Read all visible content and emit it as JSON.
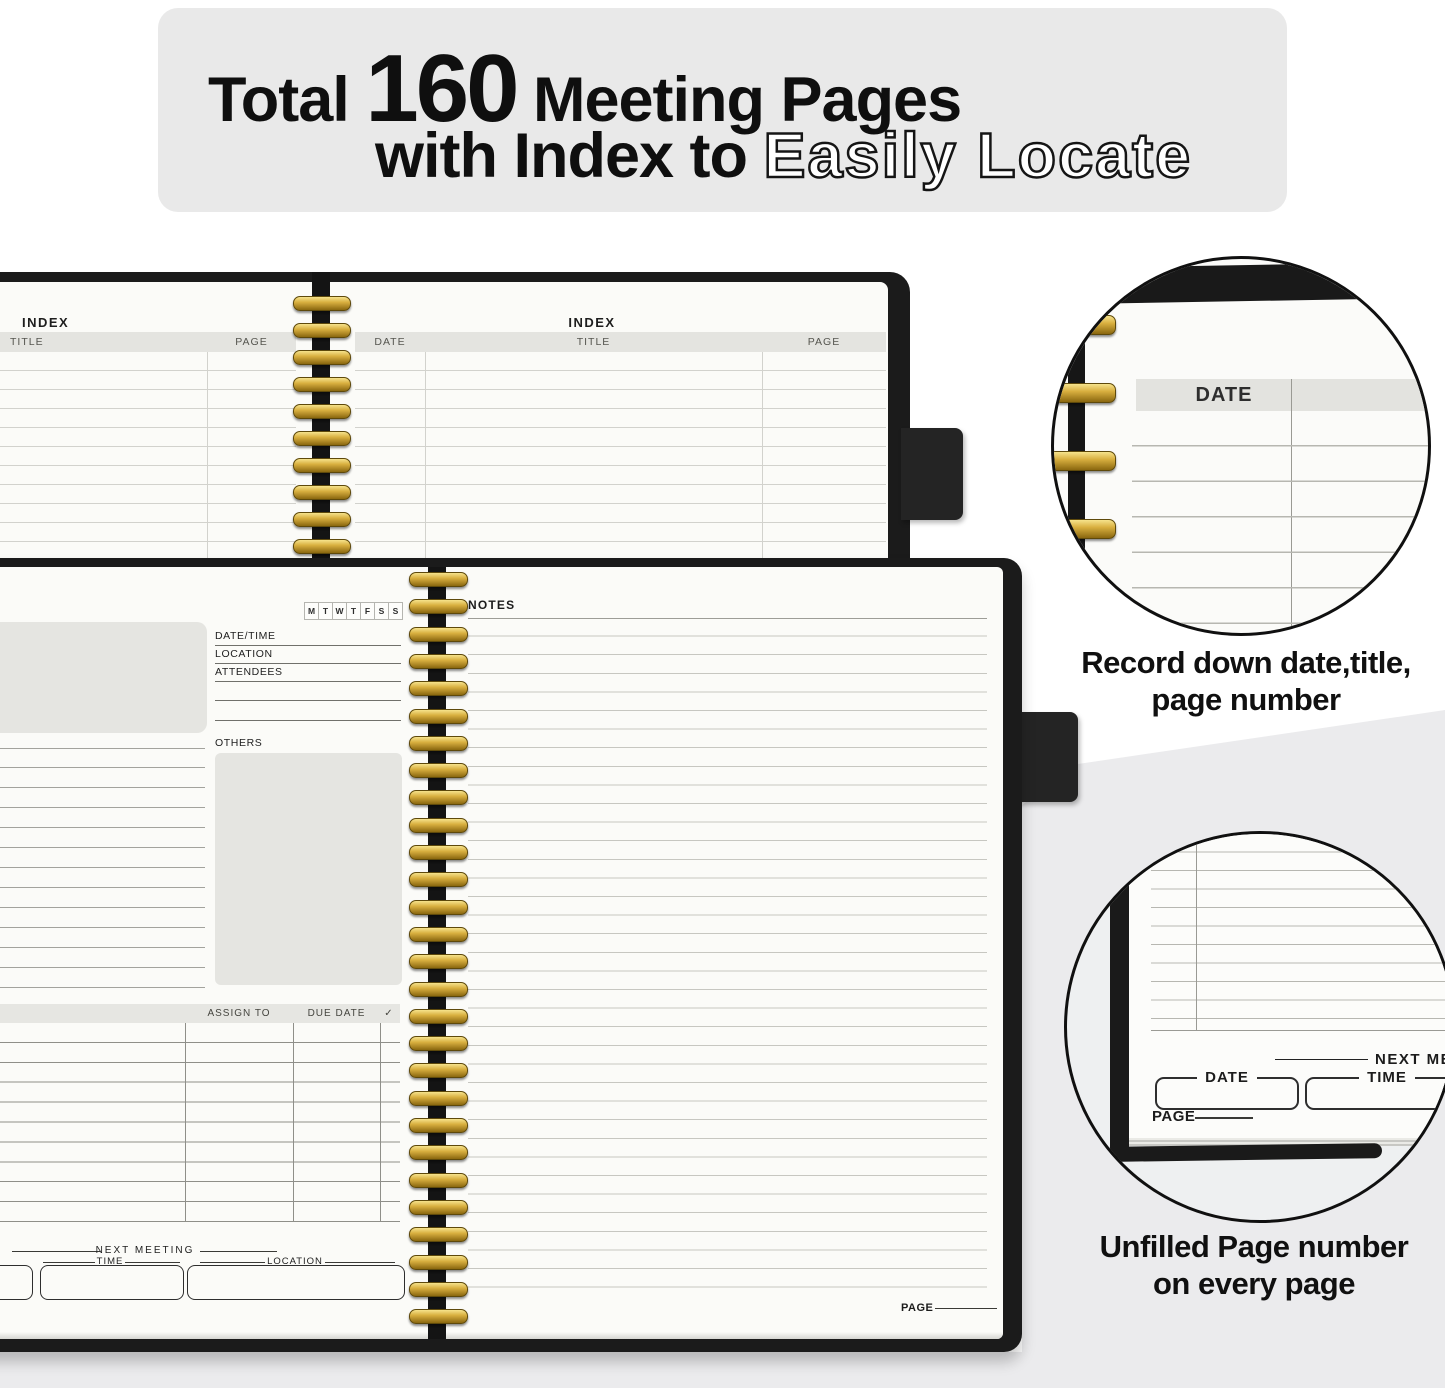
{
  "banner": {
    "line1_prefix": "Total ",
    "line1_number": "160",
    "line1_suffix": " Meeting Pages",
    "line2_text": "with Index to ",
    "line2_outline": "Easily Locate"
  },
  "index_spread": {
    "left_title": "INDEX",
    "left_col_title": "TITLE",
    "left_col_page": "PAGE",
    "right_title": "INDEX",
    "right_col_date": "DATE",
    "right_col_title": "TITLE",
    "right_col_page": "PAGE"
  },
  "meeting_spread": {
    "weekdays": [
      "M",
      "T",
      "W",
      "T",
      "F",
      "S",
      "S"
    ],
    "date_time_label": "DATE/TIME",
    "location_label": "LOCATION",
    "attendees_label": "ATTENDEES",
    "others_label": "OTHERS",
    "assign_to_label": "ASSIGN TO",
    "due_date_label": "DUE DATE",
    "check_label": "✓",
    "next_meeting_label": "NEXT  MEETING",
    "time_label": "TIME",
    "next_location_label": "LOCATION",
    "notes_label": "NOTES",
    "page_label": "PAGE"
  },
  "callout_top": {
    "date_label": "DATE",
    "caption_line1": "Record down date,title,",
    "caption_line2": "page number"
  },
  "callout_bottom": {
    "next_meeting_label": "NEXT  MEETIN",
    "date_label": "DATE",
    "time_label": "TIME",
    "page_label": "PAGE",
    "caption_line1": "Unfilled Page number",
    "caption_line2": "on every page"
  },
  "colors": {
    "gold": "#d9b040",
    "cover_black": "#1b1b1b",
    "page": "#fbfbf8",
    "header_band": "#e4e4e0",
    "banner_bg": "#e9e9e9",
    "background_gray": "#ebebed"
  }
}
